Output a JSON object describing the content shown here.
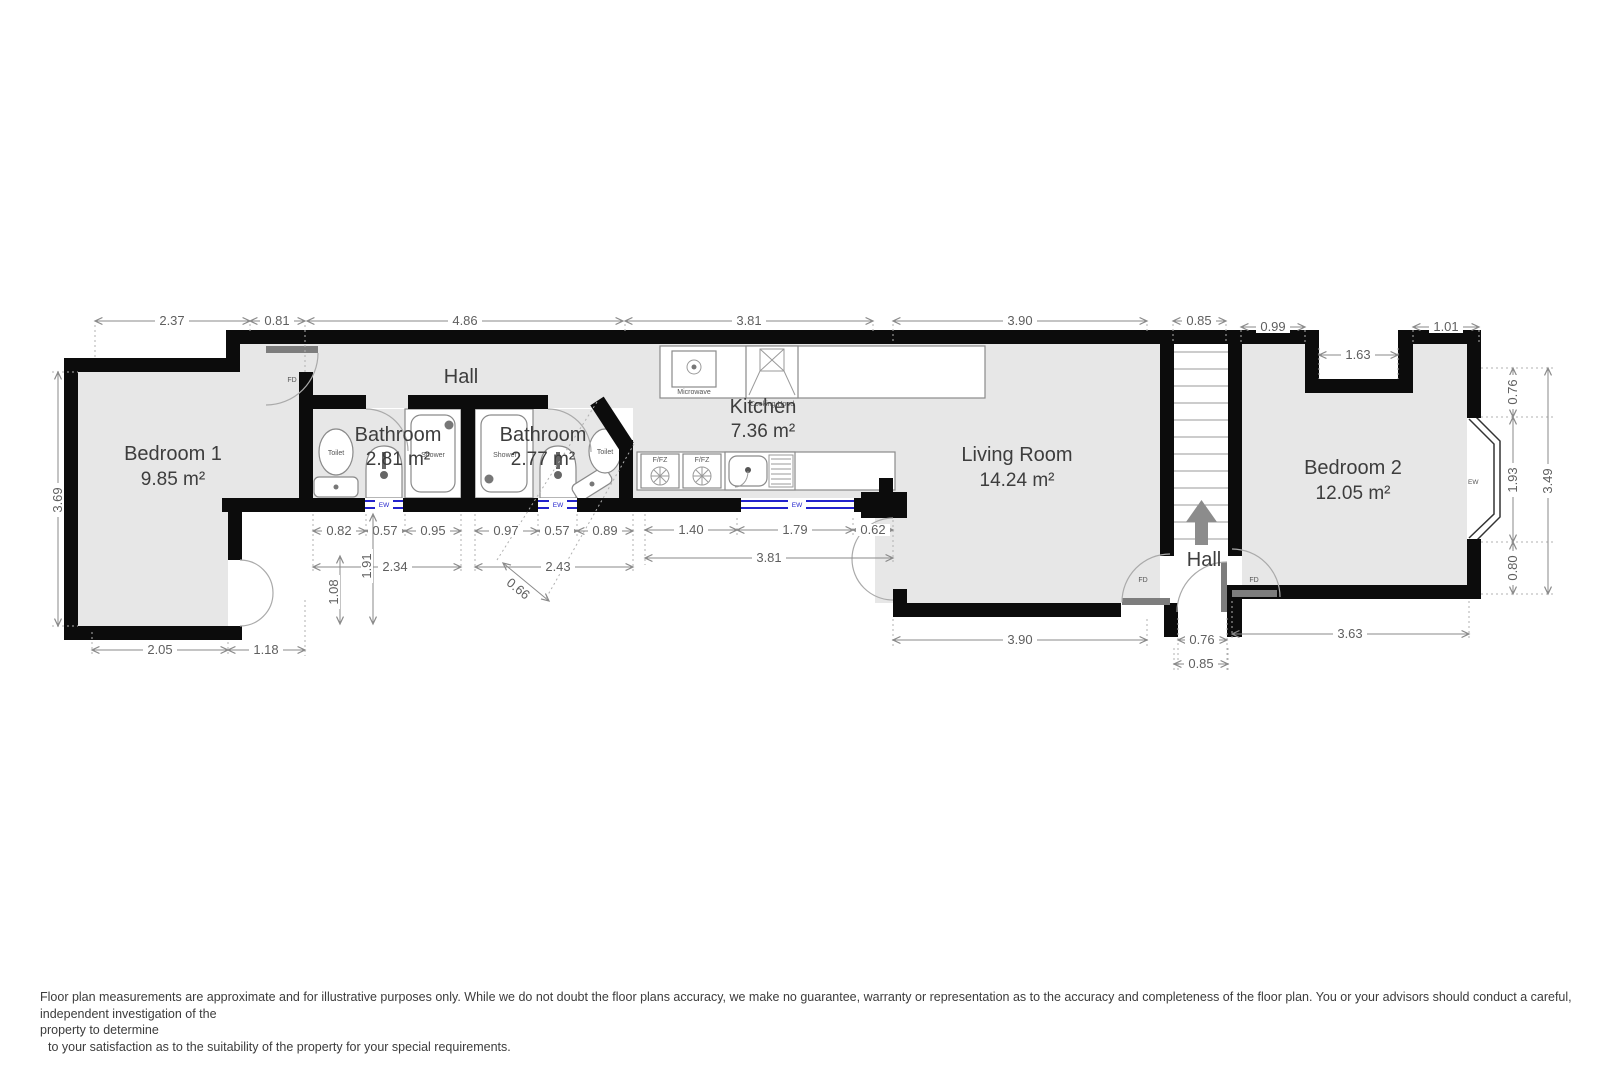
{
  "title": "Floor plan",
  "rooms": [
    {
      "id": "bedroom1",
      "name": "Bedroom 1",
      "area": "9.85 m²"
    },
    {
      "id": "hall",
      "name": "Hall",
      "area": ""
    },
    {
      "id": "bathroom1",
      "name": "Bathroom",
      "area": "2.81 m²"
    },
    {
      "id": "bathroom2",
      "name": "Bathroom",
      "area": "2.77 m²"
    },
    {
      "id": "kitchen",
      "name": "Kitchen",
      "area": "7.36 m²"
    },
    {
      "id": "living",
      "name": "Living Room",
      "area": "14.24 m²"
    },
    {
      "id": "hall2",
      "name": "Hall",
      "area": ""
    },
    {
      "id": "bedroom2",
      "name": "Bedroom 2",
      "area": "12.05 m²"
    }
  ],
  "fixtures": {
    "toilet": "Toilet",
    "shower": "Shower",
    "microwave": "Microwave",
    "cooking_hood": "Cooking Hood",
    "fridge_freezer": "F/FZ",
    "sink": "Sink",
    "window": "EW",
    "fire_door": "FD"
  },
  "dims": {
    "top": [
      "2.37",
      "0.81",
      "4.86",
      "3.81",
      "3.90",
      "0.85",
      "0.99",
      "1.01",
      "1.63"
    ],
    "left": [
      "3.69"
    ],
    "right": [
      "0.76",
      "1.93",
      "0.80",
      "3.49"
    ],
    "bath1_row": [
      "0.82",
      "0.57",
      "0.95"
    ],
    "bath2_row": [
      "0.97",
      "0.57",
      "0.89"
    ],
    "mid": [
      "2.34",
      "2.43",
      "1.91",
      "1.08",
      "0.66"
    ],
    "kitchen_row": [
      "1.40",
      "1.79",
      "0.62",
      "3.81"
    ],
    "bottom": [
      "2.05",
      "1.18",
      "3.90",
      "0.76",
      "0.85",
      "3.63"
    ]
  },
  "colors": {
    "wall": "#0c0c0c",
    "floor": "#e7e7e7",
    "window_blue": "#2222cc",
    "dim_text": "#5f5f5f"
  },
  "disclaimer": {
    "line1": "Floor plan measurements are approximate and for illustrative purposes only. While we do not doubt the floor plans accuracy, we make no guarantee, warranty or representation as to the accuracy and completeness of the floor plan. You or your advisors should conduct a careful, independent investigation of the",
    "line2": "property to determine",
    "line3": "to your satisfaction as to the suitability of the property for your special requirements."
  }
}
